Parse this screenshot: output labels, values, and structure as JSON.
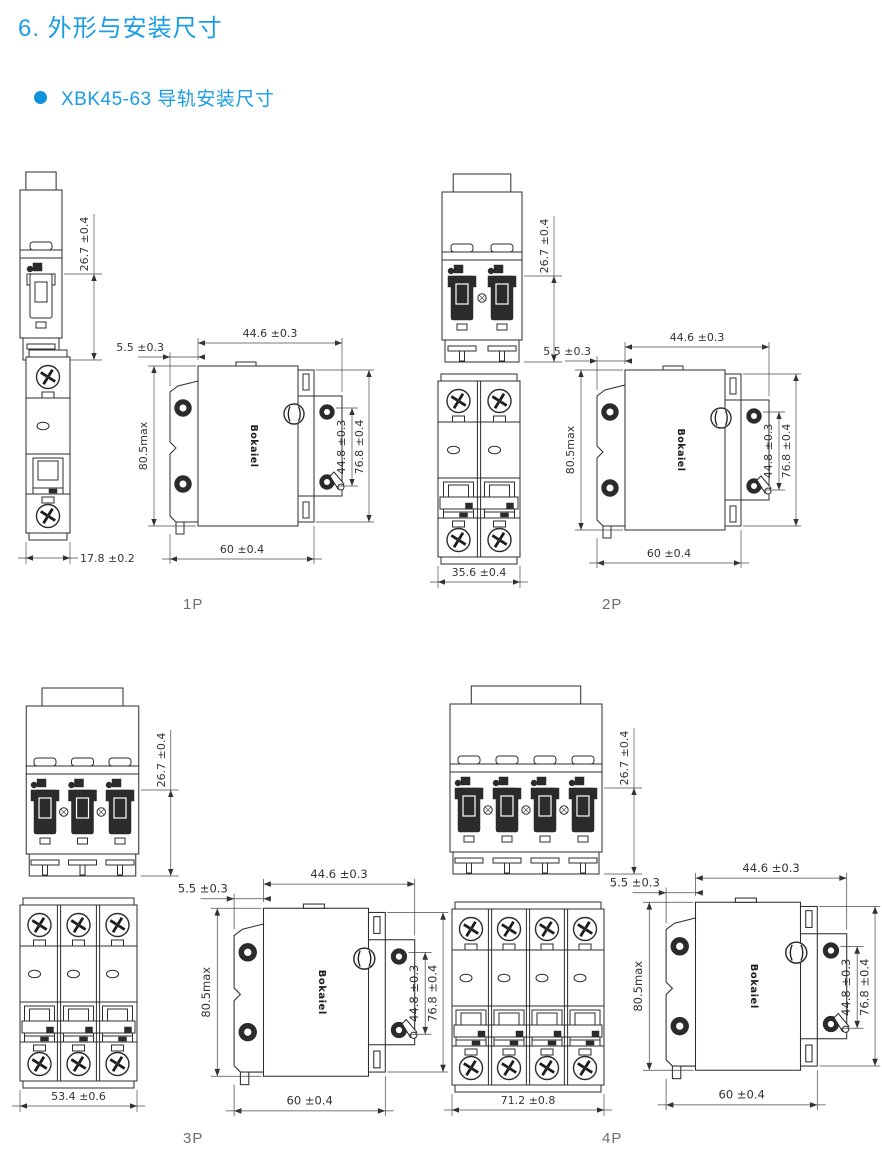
{
  "page": {
    "title": "6. 外形与安装尺寸",
    "bullet_item": "XBK45-63 导轨安装尺寸",
    "accent_color": "#1b9de6"
  },
  "brand_text": "Bokaiel",
  "dimensions": {
    "toggle_height": "26.7 ±0.4",
    "top_width": "44.6 ±0.3",
    "rail_offset": "5.5 ±0.3",
    "body_height": "80.5max",
    "inner_height": "44.8 ±0.3",
    "outer_height": "76.8 ±0.4",
    "depth": "60 ±0.4"
  },
  "panels": [
    {
      "label": "1P",
      "poles": 1,
      "width_dim": "17.8 ±0.2"
    },
    {
      "label": "2P",
      "poles": 2,
      "width_dim": "35.6 ±0.4"
    },
    {
      "label": "3P",
      "poles": 3,
      "width_dim": "53.4 ±0.6"
    },
    {
      "label": "4P",
      "poles": 4,
      "width_dim": "71.2 ±0.8"
    }
  ]
}
